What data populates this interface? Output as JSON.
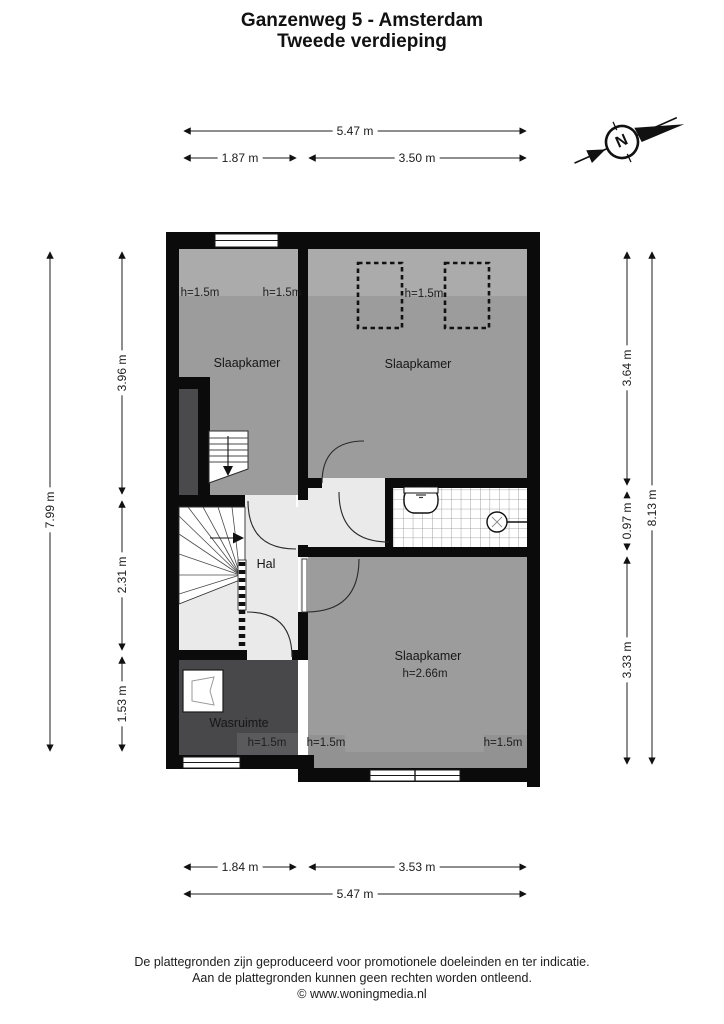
{
  "title": {
    "line1": "Ganzenweg 5 - Amsterdam",
    "line2": "Tweede verdieping"
  },
  "compass": {
    "letter": "N"
  },
  "dimensions": {
    "top_total": "5.47 m",
    "top_left": "1.87 m",
    "top_right": "3.50 m",
    "bottom_left": "1.84 m",
    "bottom_right": "3.53 m",
    "bottom_total": "5.47 m",
    "left_total": "7.99 m",
    "left_seg1": "3.96 m",
    "left_seg2": "2.31 m",
    "left_seg3": "1.53 m",
    "right_seg1": "3.64 m",
    "right_seg2": "0.97 m",
    "right_seg3": "3.33 m",
    "right_total": "8.13 m"
  },
  "rooms": {
    "bedroom_top_left": {
      "name": "Slaapkamer",
      "h_left": "h=1.5m",
      "h_right": "h=1.5m"
    },
    "bedroom_top_right": {
      "name": "Slaapkamer",
      "h": "h=1.5m"
    },
    "hall": {
      "name": "Hal"
    },
    "laundry": {
      "name": "Wasruimte",
      "h": "h=1.5m"
    },
    "bedroom_bottom": {
      "name": "Slaapkamer",
      "h_ceiling": "h=2.66m",
      "h_left": "h=1.5m",
      "h_right": "h=1.5m"
    }
  },
  "footer": {
    "line1": "De plattegronden zijn geproduceerd voor promotionele doeleinden en ter indicatie.",
    "line2": "Aan de plattegronden kunnen geen rechten worden ontleend.",
    "line3": "© www.woningmedia.nl"
  },
  "colors": {
    "wall": "#0b0b0b",
    "room_floor": "#9c9c9c",
    "low_ceiling_band": "#ababab",
    "hall_floor": "#eaeaea",
    "laundry_floor": "#48484a",
    "void_shaft": "#4a4a4c",
    "bathroom_tile_line": "#8d8d8d"
  }
}
